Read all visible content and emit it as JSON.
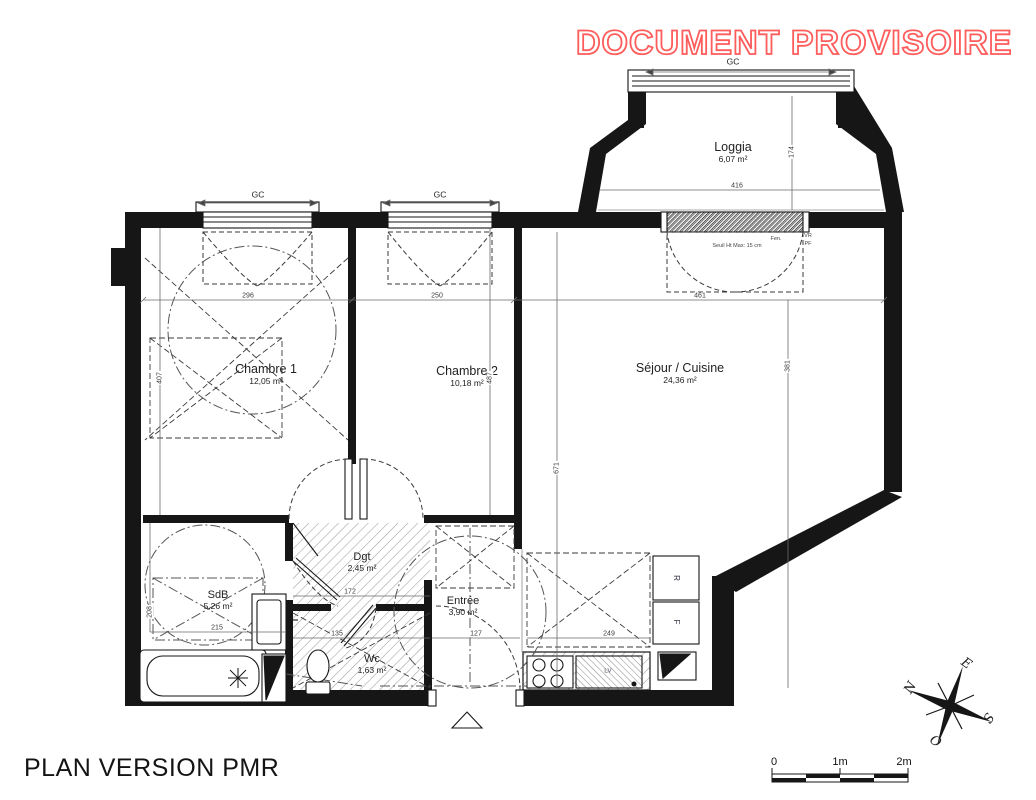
{
  "stamp": "DOCUMENT PROVISOIRE",
  "plan_title": "PLAN VERSION PMR",
  "rooms": {
    "chambre1": {
      "name": "Chambre 1",
      "area": "12,05 m²"
    },
    "chambre2": {
      "name": "Chambre 2",
      "area": "10,18 m²"
    },
    "sejour": {
      "name": "Séjour / Cuisine",
      "area": "24,36 m²"
    },
    "loggia": {
      "name": "Loggia",
      "area": "6,07 m²"
    },
    "sdb": {
      "name": "SdB",
      "area": "5,26 m²"
    },
    "dgt": {
      "name": "Dgt",
      "area": "2,45 m²"
    },
    "entree": {
      "name": "Entrée",
      "area": "3,90 m²"
    },
    "wc": {
      "name": "Wc",
      "area": "1,63 m²"
    }
  },
  "window_label": "GC",
  "annotations": {
    "seuil": "Seuil Ht Max: 15 cm",
    "fen": "Fen.",
    "vr": "VR",
    "pf": "PF",
    "fridge": "R",
    "oven": "F",
    "dishwasher": "LV"
  },
  "dimensions": {
    "chambre1_width": "296",
    "chambre2_width": "250",
    "sejour_width": "461",
    "chambre1_height": "407",
    "chambre2_height": "487",
    "sejour_height": "381",
    "hall_height": "671",
    "loggia_height": "174",
    "loggia_width": "416",
    "sdb_width": "215",
    "sdb_height": "208",
    "dgt_width": "172",
    "wc_width": "135",
    "entree_width": "127",
    "kitchen_width": "249"
  },
  "scale_bar": {
    "labels": [
      "0",
      "1m",
      "2m"
    ]
  },
  "compass": {
    "north": "N",
    "east": "E",
    "south": "S",
    "west": "O"
  },
  "colors": {
    "stamp_red": "#ff5c5c",
    "wall_black": "#161616"
  }
}
